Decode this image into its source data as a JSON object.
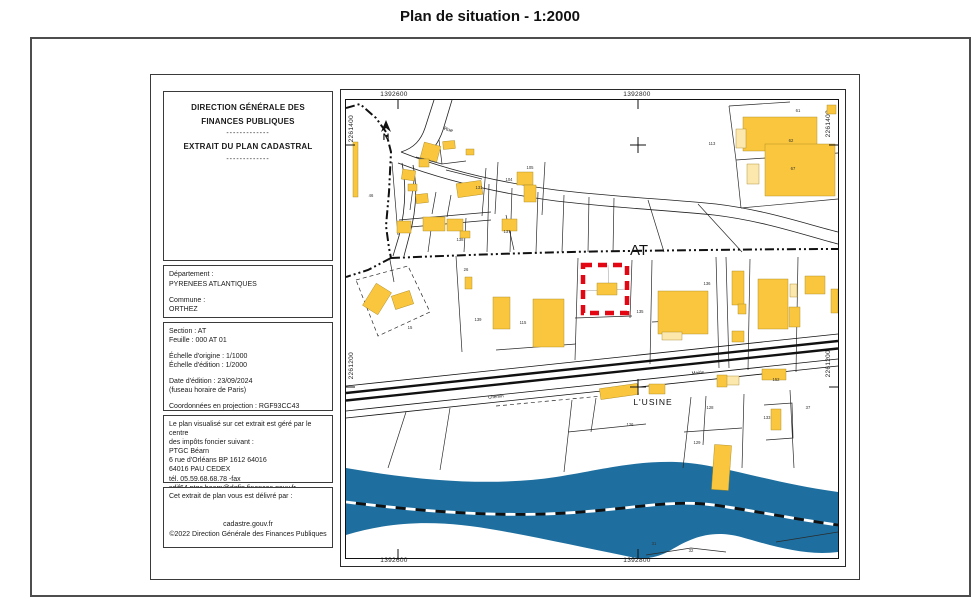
{
  "title": "Plan de situation - 1:2000",
  "document": {
    "header": {
      "line1": "DIRECTION GÉNÉRALE DES",
      "line2": "FINANCES PUBLIQUES",
      "divider1": "-------------",
      "line3": "EXTRAIT DU PLAN CADASTRAL",
      "divider2": "-------------"
    },
    "location_box": {
      "departement_label": "Département :",
      "departement_value": "PYRENEES ATLANTIQUES",
      "commune_label": "Commune :",
      "commune_value": "ORTHEZ"
    },
    "sheet_box": {
      "section": "Section : AT",
      "feuille": "Feuille : 000 AT 01",
      "echelle_origine": "Échelle d'origine : 1/1000",
      "echelle_edition": "Échelle d'édition : 1/2000",
      "date_edition": "Date d'édition : 23/09/2024",
      "fuseau": "(fuseau horaire de Paris)",
      "projection": "Coordonnées en projection : RGF93CC43"
    },
    "office_box": {
      "line1": "Le plan visualisé sur cet extrait est géré par le centre",
      "line2": "des impôts foncier suivant :",
      "line3": "PTGC Béarn",
      "line4": "6 rue d'Orléans BP 1612 64016",
      "line5": "64016 PAU CEDEX",
      "line6": "tél. 05.59.68.68.78 -fax",
      "line7": "sdif64.ptgc.bearn@dgfip.finances.gouv.fr"
    },
    "delivery_box": {
      "line1": "Cet extrait de plan vous est délivré par :",
      "line2": "cadastre.gouv.fr",
      "line3": "©2022 Direction Générale des Finances Publiques"
    }
  },
  "map": {
    "coordinates": {
      "top_left": "1392600",
      "top_right": "1392800",
      "bottom_left": "1392600",
      "bottom_right": "1392800",
      "left_top": "2261400",
      "left_bottom": "2261200",
      "right_top": "2261400",
      "right_bottom": "2261200"
    },
    "colors": {
      "building": "#fac63e",
      "building_light": "#fce7ad",
      "river": "#1e6f9f",
      "highlight_red": "#e30613",
      "line": "#1a1a1a"
    },
    "text_labels": [
      {
        "name": "section-at-label",
        "t": "AT",
        "x": 293,
        "y": 155,
        "size": 15
      },
      {
        "name": "usine-label",
        "t": "L'USINE",
        "x": 307,
        "y": 305,
        "size": 8.5,
        "spacing": 1
      },
      {
        "name": "north-label",
        "t": "N",
        "x": 40,
        "y": 40,
        "size": 9,
        "bold": true
      },
      {
        "name": "rue-label",
        "t": "Rue",
        "x": 102,
        "y": 31,
        "size": 5,
        "rot": 15
      },
      {
        "name": "chemin-label",
        "t": "Chemin",
        "x": 150,
        "y": 298,
        "size": 4.5,
        "rot": -6
      },
      {
        "name": "mairie-label",
        "t": "Mairie",
        "x": 352,
        "y": 274,
        "size": 4.5,
        "rot": -6
      }
    ],
    "parcel_labels": [
      {
        "t": "46",
        "x": 25,
        "y": 97
      },
      {
        "t": "104",
        "x": 163,
        "y": 81
      },
      {
        "t": "105",
        "x": 184,
        "y": 69
      },
      {
        "t": "131",
        "x": 133,
        "y": 89
      },
      {
        "t": "138",
        "x": 114,
        "y": 141
      },
      {
        "t": "137",
        "x": 161,
        "y": 133
      },
      {
        "t": "113",
        "x": 366,
        "y": 45
      },
      {
        "t": "61",
        "x": 452,
        "y": 12
      },
      {
        "t": "62",
        "x": 445,
        "y": 42
      },
      {
        "t": "67",
        "x": 447,
        "y": 70
      },
      {
        "t": "26",
        "x": 120,
        "y": 171
      },
      {
        "t": "15",
        "x": 64,
        "y": 229
      },
      {
        "t": "139",
        "x": 132,
        "y": 221
      },
      {
        "t": "115",
        "x": 177,
        "y": 224
      },
      {
        "t": "135",
        "x": 294,
        "y": 213
      },
      {
        "t": "136",
        "x": 361,
        "y": 185
      },
      {
        "t": "126",
        "x": 284,
        "y": 326
      },
      {
        "t": "128",
        "x": 364,
        "y": 309
      },
      {
        "t": "129",
        "x": 351,
        "y": 344
      },
      {
        "t": "152",
        "x": 430,
        "y": 281
      },
      {
        "t": "133",
        "x": 421,
        "y": 319
      },
      {
        "t": "37",
        "x": 462,
        "y": 309
      },
      {
        "t": "31",
        "x": 308,
        "y": 445
      },
      {
        "t": "32",
        "x": 345,
        "y": 452
      }
    ],
    "buildings": [
      {
        "x": 7,
        "y": 42,
        "w": 5,
        "h": 55
      },
      {
        "x": 76,
        "y": 44,
        "w": 17,
        "h": 16,
        "rot": 15
      },
      {
        "x": 97,
        "y": 41,
        "w": 12,
        "h": 8,
        "rot": -5
      },
      {
        "x": 73,
        "y": 59,
        "w": 10,
        "h": 8
      },
      {
        "x": 56,
        "y": 70,
        "w": 13,
        "h": 10,
        "rot": 8
      },
      {
        "x": 62,
        "y": 84,
        "w": 9,
        "h": 7
      },
      {
        "x": 70,
        "y": 94,
        "w": 12,
        "h": 9,
        "rot": -6
      },
      {
        "x": 111,
        "y": 82,
        "w": 25,
        "h": 14,
        "rot": -8
      },
      {
        "x": 171,
        "y": 72,
        "w": 16,
        "h": 13
      },
      {
        "x": 178,
        "y": 85,
        "w": 12,
        "h": 17
      },
      {
        "x": 120,
        "y": 49,
        "w": 8,
        "h": 6
      },
      {
        "x": 51,
        "y": 121,
        "w": 14,
        "h": 12
      },
      {
        "x": 77,
        "y": 117,
        "w": 22,
        "h": 14
      },
      {
        "x": 101,
        "y": 119,
        "w": 16,
        "h": 12
      },
      {
        "x": 114,
        "y": 131,
        "w": 10,
        "h": 7
      },
      {
        "x": 156,
        "y": 119,
        "w": 15,
        "h": 12
      },
      {
        "x": 397,
        "y": 17,
        "w": 74,
        "h": 34
      },
      {
        "x": 419,
        "y": 44,
        "w": 70,
        "h": 52
      },
      {
        "x": 481,
        "y": 5,
        "w": 9,
        "h": 9
      },
      {
        "x": 390,
        "y": 29,
        "w": 10,
        "h": 19,
        "light": true
      },
      {
        "x": 401,
        "y": 64,
        "w": 12,
        "h": 20,
        "light": true
      },
      {
        "x": 22,
        "y": 186,
        "w": 18,
        "h": 26,
        "rot": 32
      },
      {
        "x": 47,
        "y": 193,
        "w": 19,
        "h": 14,
        "rot": -18
      },
      {
        "x": 119,
        "y": 177,
        "w": 7,
        "h": 12
      },
      {
        "x": 147,
        "y": 197,
        "w": 17,
        "h": 32
      },
      {
        "x": 187,
        "y": 199,
        "w": 31,
        "h": 48
      },
      {
        "x": 251,
        "y": 183,
        "w": 20,
        "h": 12
      },
      {
        "x": 312,
        "y": 191,
        "w": 50,
        "h": 43
      },
      {
        "x": 316,
        "y": 232,
        "w": 20,
        "h": 8,
        "light": true
      },
      {
        "x": 386,
        "y": 171,
        "w": 12,
        "h": 34
      },
      {
        "x": 392,
        "y": 204,
        "w": 8,
        "h": 10
      },
      {
        "x": 386,
        "y": 231,
        "w": 12,
        "h": 11
      },
      {
        "x": 412,
        "y": 179,
        "w": 30,
        "h": 50
      },
      {
        "x": 443,
        "y": 207,
        "w": 11,
        "h": 20
      },
      {
        "x": 444,
        "y": 184,
        "w": 7,
        "h": 13,
        "light": true
      },
      {
        "x": 459,
        "y": 176,
        "w": 20,
        "h": 18
      },
      {
        "x": 485,
        "y": 189,
        "w": 7,
        "h": 24
      },
      {
        "x": 254,
        "y": 286,
        "w": 38,
        "h": 11,
        "rot": -8
      },
      {
        "x": 303,
        "y": 284,
        "w": 16,
        "h": 10
      },
      {
        "x": 378,
        "y": 276,
        "w": 15,
        "h": 9,
        "light": true
      },
      {
        "x": 371,
        "y": 275,
        "w": 10,
        "h": 12
      },
      {
        "x": 416,
        "y": 269,
        "w": 24,
        "h": 11
      },
      {
        "x": 425,
        "y": 309,
        "w": 10,
        "h": 21
      },
      {
        "x": 367,
        "y": 345,
        "w": 17,
        "h": 45,
        "rot": 4
      }
    ]
  }
}
